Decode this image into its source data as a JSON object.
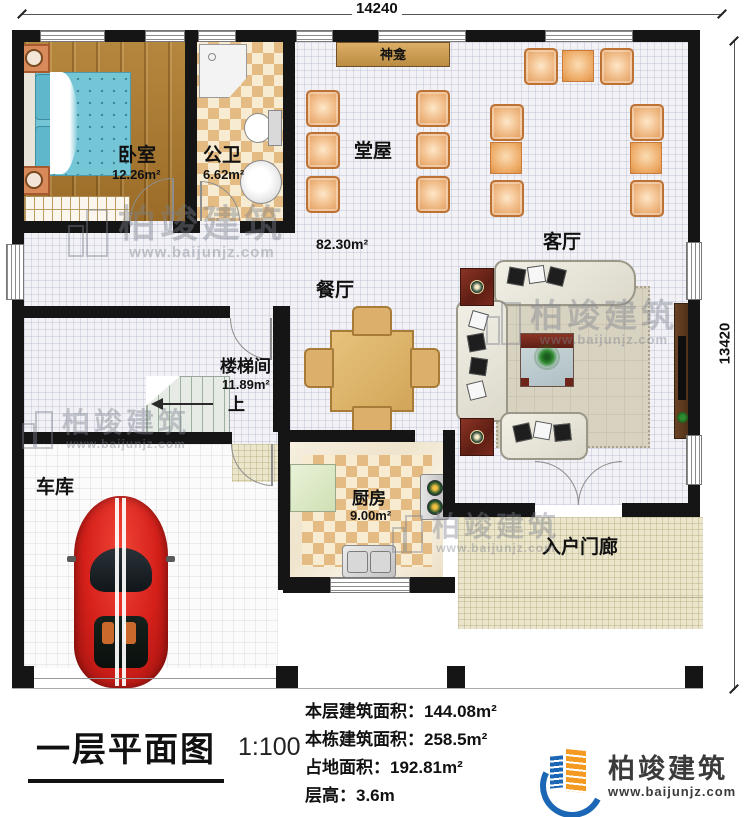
{
  "dimensions": {
    "width_mm": "14240",
    "height_mm": "13420"
  },
  "rooms": {
    "bedroom": {
      "name": "卧室",
      "area": "12.26m²"
    },
    "bathroom": {
      "name": "公卫",
      "area": "6.62m²"
    },
    "shrine": {
      "name": "神龛"
    },
    "hall": {
      "name": "堂屋",
      "area": "82.30m²"
    },
    "living": {
      "name": "客厅"
    },
    "dining": {
      "name": "餐厅"
    },
    "stairwell": {
      "name": "楼梯间",
      "area": "11.89m²",
      "up": "上"
    },
    "garage": {
      "name": "车库"
    },
    "kitchen": {
      "name": "厨房",
      "area": "9.00m²"
    },
    "porch": {
      "name": "入户门廊"
    }
  },
  "annotation": {
    "title": "一层平面图",
    "scale": "1:100",
    "stats": [
      "本层建筑面积：144.08m²",
      "本栋建筑面积：258.5m²",
      "占地面积：192.81m²",
      "层高：3.6m"
    ]
  },
  "logo": {
    "name": "柏竣建筑",
    "url": "www.baijunjz.com"
  },
  "watermark": {
    "name": "柏竣建筑",
    "url": "www.baijunjz.com"
  },
  "colors": {
    "wall": "#151515",
    "chair": "#eda963",
    "accent_red": "#7a2b1d",
    "logo_blue": "#1b66b5",
    "logo_orange": "#f59a20"
  }
}
